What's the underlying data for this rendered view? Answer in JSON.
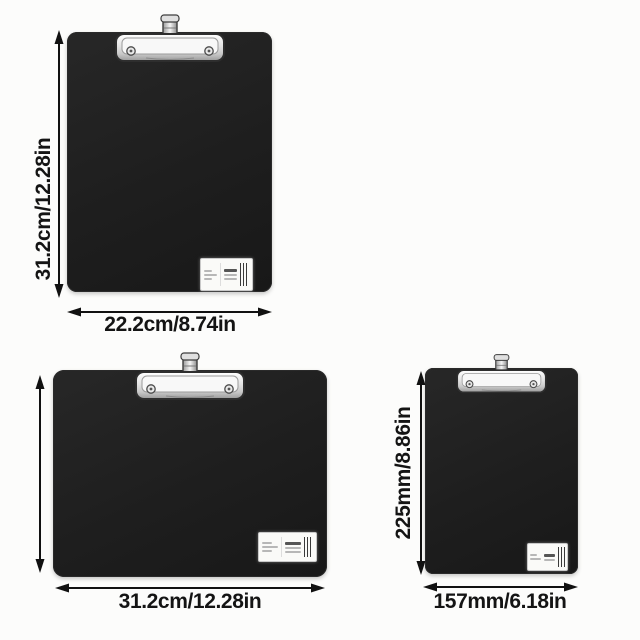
{
  "colors": {
    "background": "#fcfcfb",
    "board": "#1f1f1f",
    "dimension_text": "#141414",
    "clip_metal": "#e9e9e9",
    "arrow": "#111111"
  },
  "clipboards": [
    {
      "id": "clipboard-portrait-large",
      "orientation": "portrait",
      "height_label": "31.2cm/12.28in",
      "width_label": "22.2cm/8.74in"
    },
    {
      "id": "clipboard-landscape",
      "orientation": "landscape",
      "height_label": "",
      "width_label": "31.2cm/12.28in"
    },
    {
      "id": "clipboard-portrait-small",
      "orientation": "portrait",
      "height_label": "225mm/8.86in",
      "width_label": "157mm/6.18in"
    }
  ]
}
